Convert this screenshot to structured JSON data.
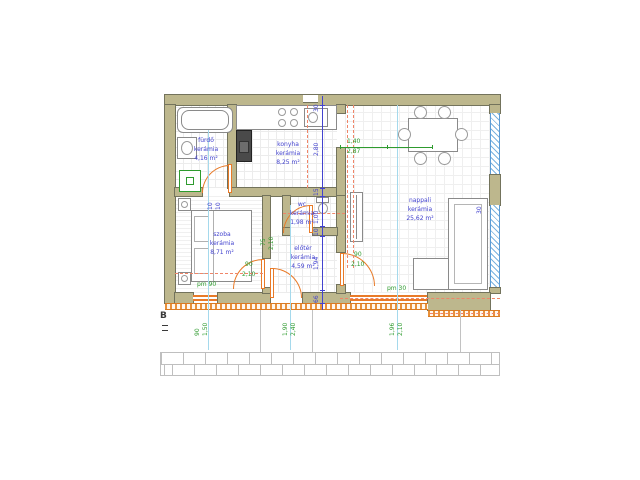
{
  "drawing": {
    "type": "floor-plan",
    "rooms": [
      {
        "name": "fürdő",
        "material": "kerámia",
        "area": "4,16 m²"
      },
      {
        "name": "konyha",
        "material": "kerámia",
        "area": "8,25 m²"
      },
      {
        "name": "nappali",
        "material": "kerámia",
        "area": "25,62 m²"
      },
      {
        "name": "szoba",
        "material": "kerámia",
        "area": "8,71 m²"
      },
      {
        "name": "wc",
        "material": "kerámia",
        "area": "1,98 m²"
      },
      {
        "name": "előtér",
        "material": "kerámia",
        "area": "4,59 m²"
      }
    ],
    "dimensions": {
      "chain_vertical": [
        "30",
        "2,80",
        "15",
        "1,00",
        "10",
        "1,94",
        "66"
      ],
      "szoba_wall_marks": [
        "10",
        "10"
      ],
      "right_wall_mark": "30",
      "table_dims": {
        "a": "1,40",
        "b": "2,87"
      },
      "wc_door": {
        "w": "75",
        "h": "2,10"
      },
      "szoba_door": {
        "w": "90",
        "h": "2,10"
      },
      "nappali_door": {
        "w": "90",
        "h": "2,10"
      },
      "window_left_parapet": "pm 90",
      "window_right_parapet": "pm 30",
      "bottom_openings": [
        {
          "a": "90",
          "b": "1,50"
        },
        {
          "a": "1,90",
          "b": "2,40"
        },
        {
          "a": "1,96",
          "b": "2,10"
        }
      ]
    },
    "markers": {
      "section": "B"
    },
    "colors": {
      "wall": "#bdb78d",
      "door_orange": "#e87a28",
      "dim_blue": "#4343cf",
      "dim_green": "#2e9b2e",
      "centerline_cyan": "#a5d9ec",
      "window_hatch_blue": "#5b9bd5"
    }
  }
}
